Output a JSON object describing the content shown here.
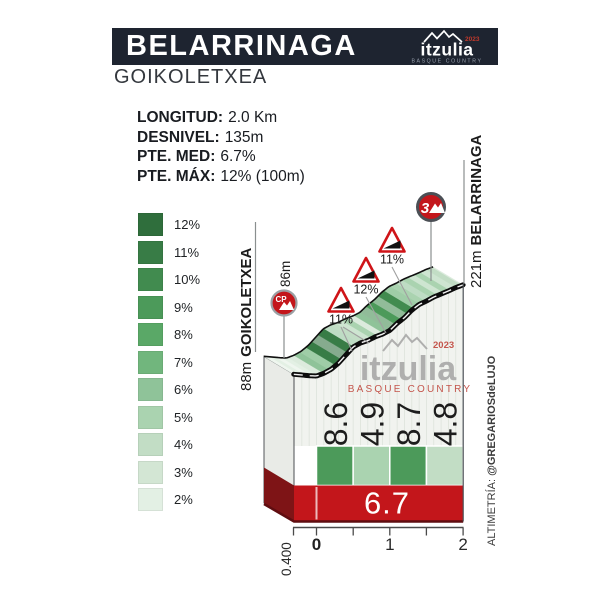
{
  "header": {
    "title": "BELARRINAGA",
    "subtitle": "GOIKOLETXEA",
    "logo": {
      "name": "itzulia",
      "year": "2023",
      "tagline": "BASQUE COUNTRY"
    }
  },
  "stats": {
    "rows": [
      {
        "label": "LONGITUD:",
        "value": "2.0 Km"
      },
      {
        "label": "DESNIVEL:",
        "value": "135m"
      },
      {
        "label": "PTE. MED:",
        "value": "6.7%"
      },
      {
        "label": "PTE. MÁX:",
        "value": "12% (100m)"
      }
    ]
  },
  "legend": {
    "items": [
      {
        "label": "12%",
        "color": "#2f6e3c"
      },
      {
        "label": "11%",
        "color": "#387c46"
      },
      {
        "label": "10%",
        "color": "#418b4f"
      },
      {
        "label": "9%",
        "color": "#4c9a5a"
      },
      {
        "label": "8%",
        "color": "#5aa867"
      },
      {
        "label": "7%",
        "color": "#71b67d"
      },
      {
        "label": "6%",
        "color": "#8fc399"
      },
      {
        "label": "5%",
        "color": "#aad3b0"
      },
      {
        "label": "4%",
        "color": "#c2ddc5"
      },
      {
        "label": "3%",
        "color": "#d3e6d4"
      },
      {
        "label": "2%",
        "color": "#e3f0e4"
      }
    ]
  },
  "chart_data": {
    "type": "area",
    "title": "BELARRINAGA (GOIKOLETXEA) climb profile",
    "x_unit": "km",
    "x_range": [
      -0.4,
      2
    ],
    "elevation_range_m": [
      86,
      221
    ],
    "profile_km_elevation_m": [
      [
        -0.31,
        88.5
      ],
      [
        -0.2,
        87.5
      ],
      [
        -0.1,
        86.5
      ],
      [
        0,
        86
      ],
      [
        0.1,
        90
      ],
      [
        0.2,
        96
      ],
      [
        0.3,
        105
      ],
      [
        0.4,
        117
      ],
      [
        0.5,
        129
      ],
      [
        0.6,
        135
      ],
      [
        0.7,
        138.5
      ],
      [
        0.8,
        144
      ],
      [
        0.9,
        148
      ],
      [
        1,
        153.5
      ],
      [
        1.1,
        164
      ],
      [
        1.2,
        172.5
      ],
      [
        1.3,
        183.5
      ],
      [
        1.4,
        192
      ],
      [
        1.5,
        197
      ],
      [
        1.6,
        203
      ],
      [
        1.7,
        207.5
      ],
      [
        1.8,
        212
      ],
      [
        1.9,
        217
      ],
      [
        2,
        221
      ]
    ],
    "start": {
      "elevation": "88m",
      "name": "GOIKOLETXEA",
      "checkpoint_elevation": "86m",
      "checkpoint_badge": "CP"
    },
    "summit": {
      "elevation": "221m",
      "name": "BELARRINAGA",
      "category_badge": "3"
    },
    "max_gradient_marks": [
      {
        "label": "11%"
      },
      {
        "label": "12%"
      },
      {
        "label": "11%"
      }
    ],
    "segments": [
      {
        "from_km": 0,
        "to_km": 0.5,
        "gradient": "8.6",
        "color": "#4c9a5a"
      },
      {
        "from_km": 0.5,
        "to_km": 1,
        "gradient": "4.9",
        "color": "#aad3b0"
      },
      {
        "from_km": 1,
        "to_km": 1.5,
        "gradient": "8.7",
        "color": "#4c9a5a"
      },
      {
        "from_km": 1.5,
        "to_km": 2,
        "gradient": "4.8",
        "color": "#c2ddc5"
      }
    ],
    "average_gradient": "6.7",
    "x_axis": {
      "tick_labels": [
        "0",
        "1",
        "2"
      ],
      "start_offset_label": "0.400"
    },
    "watermark": {
      "name": "itzulia",
      "year": "2023",
      "tagline": "BASQUE COUNTRY"
    },
    "credit_prefix": "ALTIMETRÍA: ",
    "credit_handle": "@GREGARIOSdeLUJO"
  },
  "colors": {
    "banner_bg": "#1e2430",
    "accent_red": "#c3161b",
    "dark_red": "#7e1416",
    "road_black": "#0c0c0c",
    "face_bg": "#f1f3ef",
    "grid": "#dde3db"
  }
}
